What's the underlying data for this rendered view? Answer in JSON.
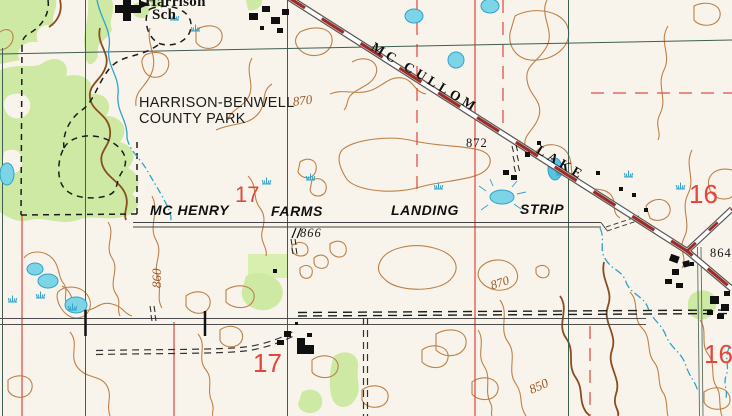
{
  "labels": {
    "school_line1": "Harrison",
    "school_line2": "Sch",
    "park_line1": "HARRISON-BENWELL",
    "park_line2": "COUNTY PARK",
    "road_word1": "MC CULLOM",
    "road_word2": "LAKE",
    "strip_word1": "MC HENRY",
    "strip_word2": "FARMS",
    "strip_word3": "LANDING",
    "strip_word4": "STRIP",
    "spot_866": "866",
    "spot_872": "872",
    "spot_864": "864",
    "contour_870_upper": "870",
    "contour_870_lower": "870",
    "contour_860": "860",
    "contour_850": "850",
    "section_17_upper": "17",
    "section_17_lower": "17",
    "section_16_upper": "16",
    "section_16_lower": "16"
  },
  "colors": {
    "paper": "#F8F4EB",
    "woodland_green": "#CDE9A3",
    "orchard_green": "#D9EFAF",
    "contour_brown": "#BE8148",
    "contour_index_brown": "#9A5A28",
    "water_blue": "#2FA3C9",
    "pond_fill": "#7DD4E6",
    "section_line_red": "#E25048",
    "section_number_red": "#E2463C",
    "road_fill_red": "#9E2B25",
    "grid_teal": "#3F5E52",
    "ink_black": "#161616"
  },
  "icons": {
    "school_symbol": "building-with-flag",
    "marsh_symbol": "grass-tuft",
    "spring_pond_symbol": "pond-with-rays",
    "fence_symbol": "double-tick"
  }
}
